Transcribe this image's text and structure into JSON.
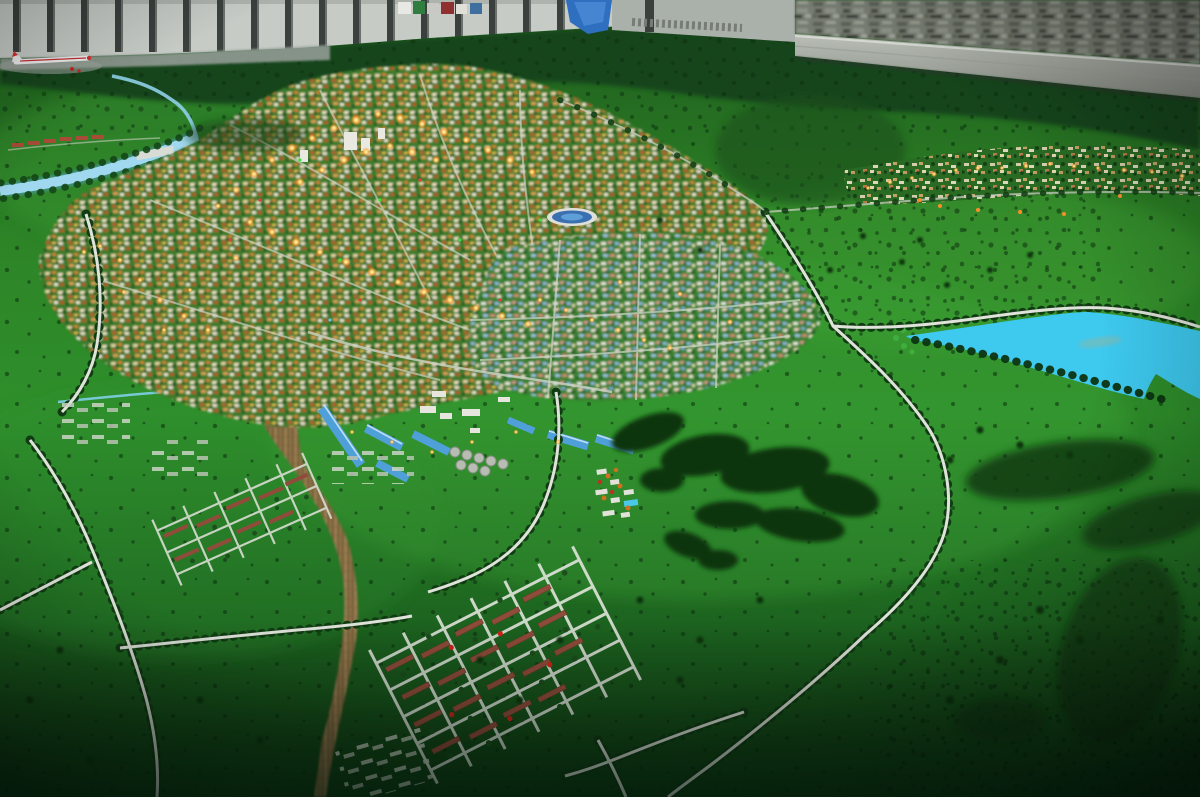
{
  "scene": {
    "title": "Photograph of a city master-plan scale model (diorama) in an exhibition hall",
    "view": "oblique aerial view over a green terrain model",
    "elements": [
      "exhibition wall with vertical pillars along the top left",
      "dense miniature city mural / model behind a gray ledge at top right",
      "small white model airplane with red markings at top left edge",
      "dense illuminated city core of tiny warm-lit buildings upper left-center",
      "light blue river winding to the left edge with a small bridge",
      "railway yard corridor of tan parallel tracks curving toward bottom center",
      "industrial zone with bright blue gabled warehouse roofs and gray storage tanks",
      "bright cyan lake with tree-lined shores on the middle right",
      "large dark-green forest patch in the center meadow",
      "planned village grid of brick-red barracks rows with white streets, lower center",
      "tree-lined avenues crossing the green plains",
      "strip of small lit settlements along the upper right",
      "clusters of white greenhouse plots on the left fields",
      "scattered dark model trees across rolling green meadows",
      "dark vignetted foreground of plain green terrain"
    ]
  },
  "colors": {
    "terrain": "#2f8428",
    "terrain_dark": "#16451a",
    "forest": "#0d3511",
    "lake": "#3ec9ef",
    "river": "#9fd8ef",
    "road": "#dfe3da",
    "railway": "#8d7347",
    "blue_roof": "#4f9fd8",
    "red_roof": "#8f4c3a",
    "wall": "#c6cbc6",
    "glow": "#ffcf6a"
  }
}
